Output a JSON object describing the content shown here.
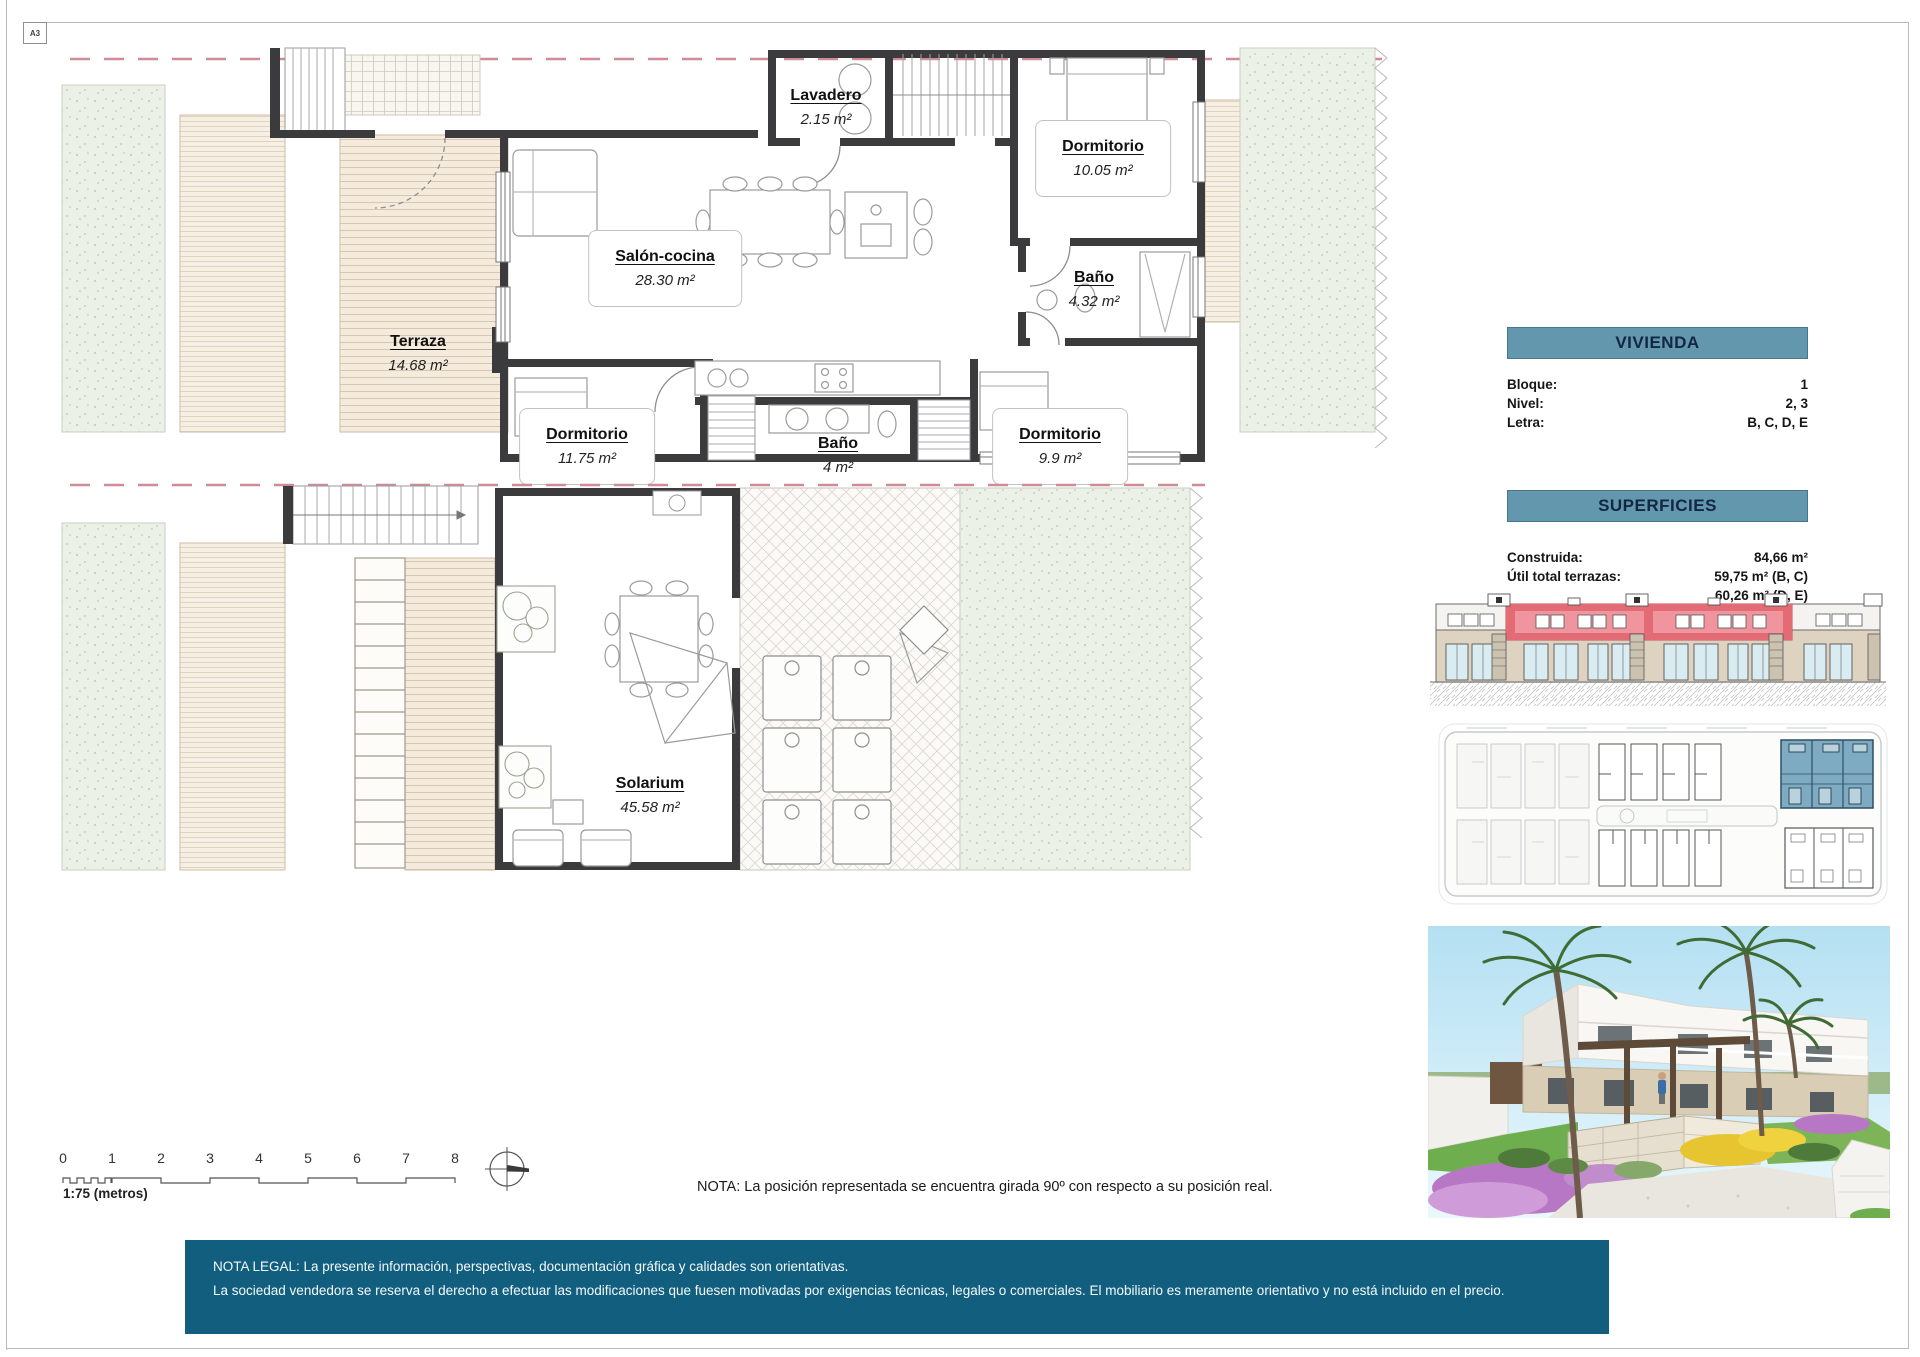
{
  "page": {
    "sheet_label": "A3"
  },
  "plans": {
    "upper": {
      "rooms": [
        {
          "name": "Lavadero",
          "area": "2.15 m²"
        },
        {
          "name": "Dormitorio",
          "area": "10.05 m²"
        },
        {
          "name": "Salón-cocina",
          "area": "28.30 m²"
        },
        {
          "name": "Baño",
          "area": "4.32 m²"
        },
        {
          "name": "Terraza",
          "area": "14.68 m²"
        },
        {
          "name": "Dormitorio",
          "area": "11.75 m²"
        },
        {
          "name": "Baño",
          "area": "4 m²"
        },
        {
          "name": "Dormitorio",
          "area": "9.9 m²"
        }
      ]
    },
    "lower": {
      "rooms": [
        {
          "name": "Solarium",
          "area": "45.58 m²"
        }
      ]
    }
  },
  "info_panel": {
    "vivienda": {
      "title": "VIVIENDA",
      "rows": [
        {
          "label": "Bloque:",
          "value": "1"
        },
        {
          "label": "Nivel:",
          "value": "2, 3"
        },
        {
          "label": "Letra:",
          "value": "B, C, D, E"
        }
      ]
    },
    "superficies": {
      "title": "SUPERFICIES",
      "rows": [
        {
          "label": "Construida:",
          "value": "84,66 m²"
        },
        {
          "label": "Útil total terrazas:",
          "value": "59,75 m² (B, C)",
          "value2": "60,26 m² (D, E)"
        }
      ]
    }
  },
  "scale": {
    "ticks": [
      "0",
      "1",
      "2",
      "3",
      "4",
      "5",
      "6",
      "7",
      "8"
    ],
    "label": "1:75 (metros)"
  },
  "nota": "NOTA: La posición representada se encuentra girada 90º con respecto a su posición real.",
  "legal": {
    "line1": "NOTA LEGAL: La presente información, perspectivas, documentación gráfica y calidades son orientativas.",
    "line2": "La sociedad vendedora se reserva el derecho a efectuar las modificaciones que fuesen motivadas por exigencias técnicas, legales o comerciales. El mobiliario es meramente orientativo y no está incluido en el precio."
  },
  "colors": {
    "banner_teal": "#6297ae",
    "footer_teal": "#115e7e",
    "elevation_highlight_red": "#ef8b95",
    "siteplan_highlight_blue": "#7fabc2",
    "boundary_dash_pink": "#d08c96",
    "wall_dark": "#3b3b3d",
    "deck_beige": "#f4ebdc",
    "garden_green": "#ebf1e6"
  }
}
